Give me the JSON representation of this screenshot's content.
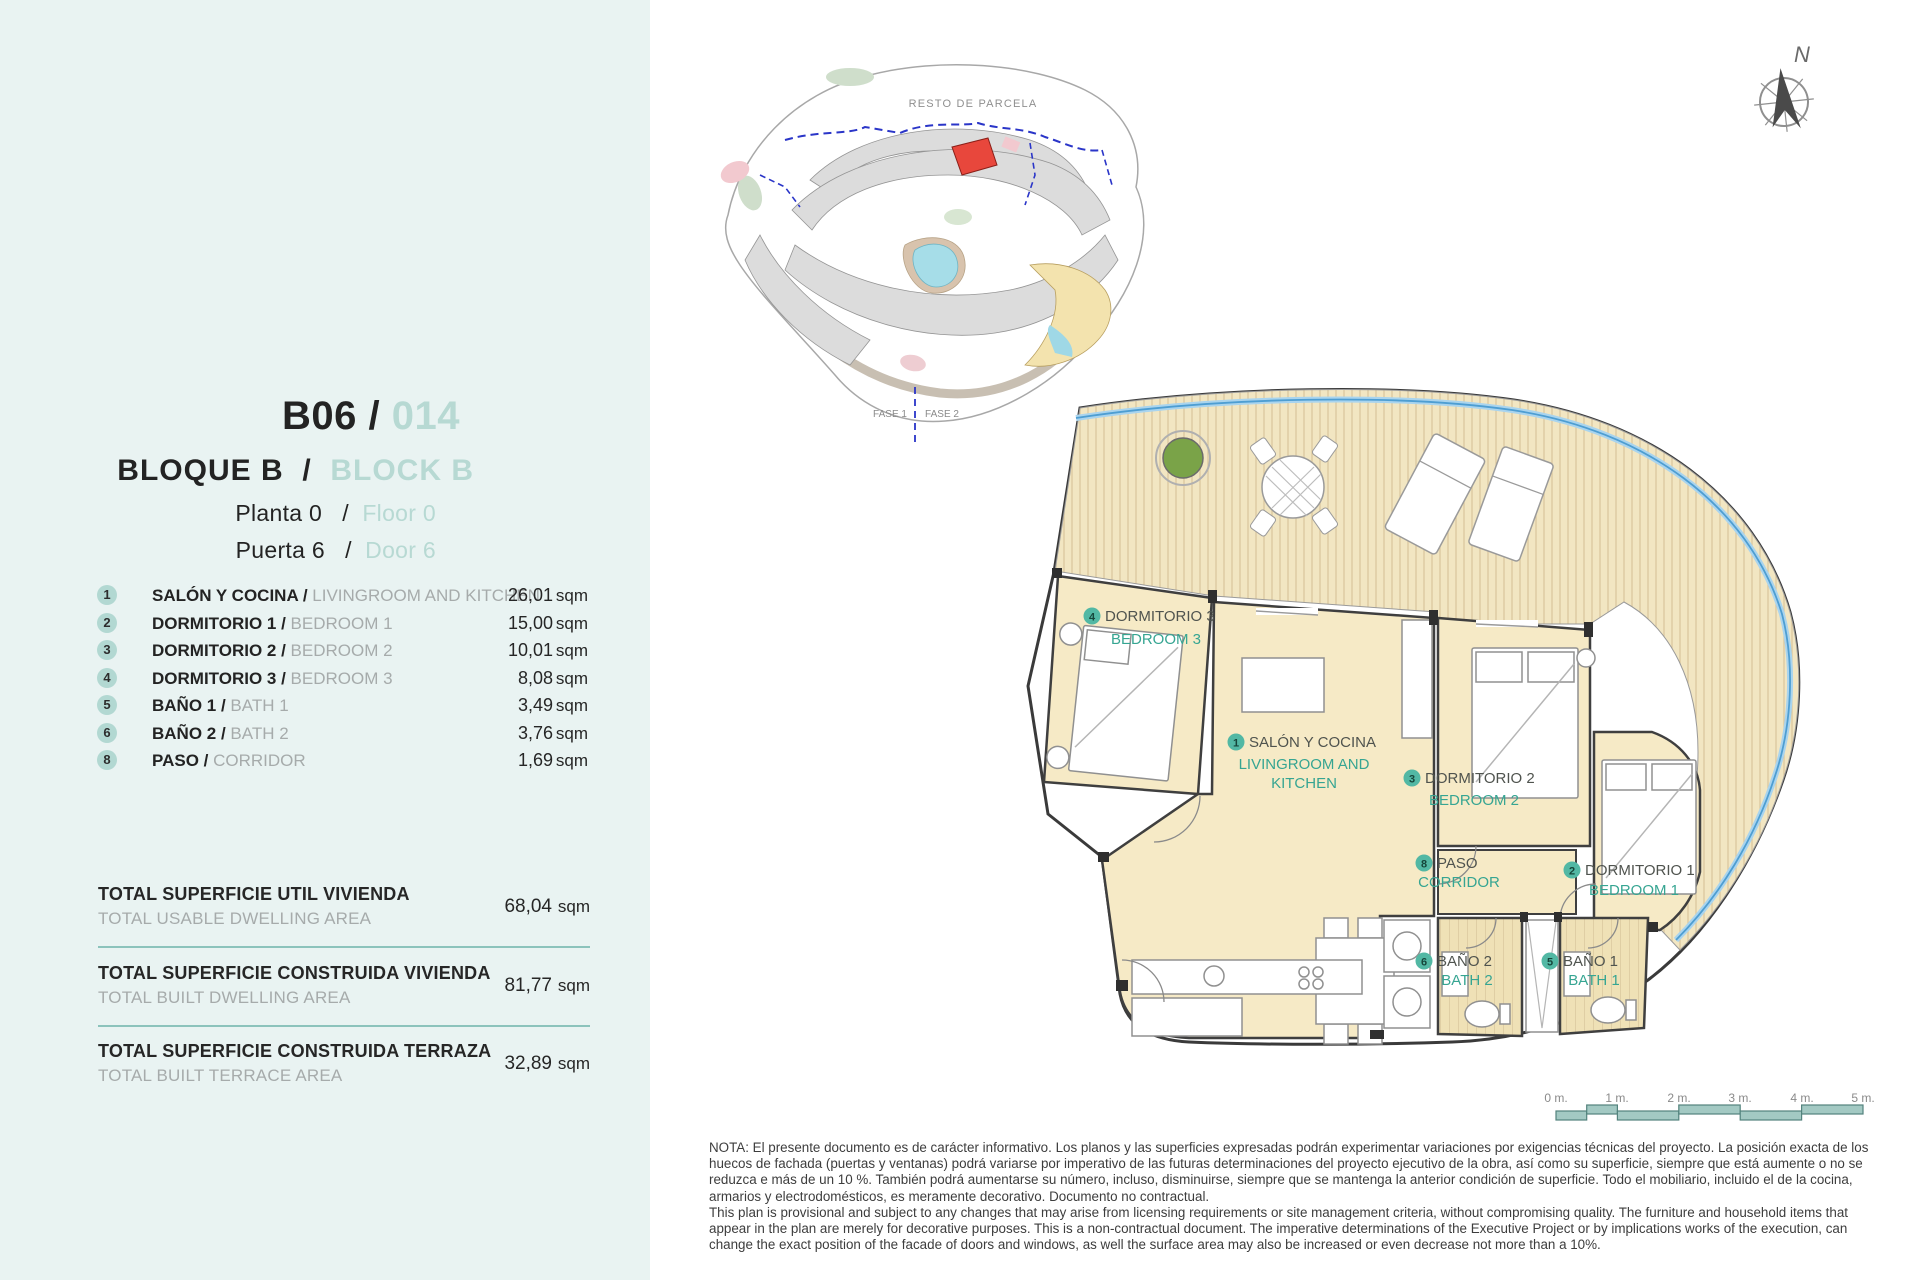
{
  "unit": {
    "code": "B06",
    "separator": "/",
    "number": "014",
    "block_es": "BLOQUE B",
    "block_en": "BLOCK B",
    "floor_es": "Planta 0",
    "floor_en": "Floor 0",
    "door_es": "Puerta 6",
    "door_en": "Door 6"
  },
  "rooms": [
    {
      "id": "1",
      "name_es": "SALÓN Y COCINA / ",
      "name_en": "LIVINGROOM AND KITCHEN",
      "area": "26,01",
      "unit": "sqm"
    },
    {
      "id": "2",
      "name_es": "DORMITORIO 1 / ",
      "name_en": "BEDROOM 1",
      "area": "15,00",
      "unit": "sqm"
    },
    {
      "id": "3",
      "name_es": "DORMITORIO 2 / ",
      "name_en": "BEDROOM 2",
      "area": "10,01",
      "unit": "sqm"
    },
    {
      "id": "4",
      "name_es": "DORMITORIO 3 / ",
      "name_en": "BEDROOM 3",
      "area": "8,08",
      "unit": "sqm"
    },
    {
      "id": "5",
      "name_es": "BAÑO 1 / ",
      "name_en": "BATH 1",
      "area": "3,49",
      "unit": "sqm"
    },
    {
      "id": "6",
      "name_es": "BAÑO 2 / ",
      "name_en": "BATH 2",
      "area": "3,76",
      "unit": "sqm"
    },
    {
      "id": "8",
      "name_es": "PASO / ",
      "name_en": "CORRIDOR",
      "area": "1,69",
      "unit": "sqm"
    }
  ],
  "totals": [
    {
      "label_es": "TOTAL SUPERFICIE UTIL VIVIENDA",
      "label_en": "TOTAL USABLE DWELLING AREA",
      "value": "68,04",
      "unit": "sqm"
    },
    {
      "label_es": "TOTAL SUPERFICIE CONSTRUIDA VIVIENDA",
      "label_en": "TOTAL BUILT DWELLING AREA",
      "value": "81,77",
      "unit": "sqm"
    },
    {
      "label_es": "TOTAL SUPERFICIE CONSTRUIDA TERRAZA",
      "label_en": "TOTAL BUILT TERRACE AREA",
      "value": "32,89",
      "unit": "sqm"
    }
  ],
  "site_plan": {
    "area_label": "RESTO DE PARCELA",
    "phase1": "FASE 1",
    "phase2": "FASE 2"
  },
  "compass": {
    "north": "N"
  },
  "floor_plan": {
    "salon": {
      "num": "1",
      "es": "SALÓN Y COCINA",
      "en1": "LIVINGROOM AND",
      "en2": "KITCHEN"
    },
    "dorm1": {
      "num": "2",
      "es": "DORMITORIO 1",
      "en": "BEDROOM 1"
    },
    "dorm2": {
      "num": "3",
      "es": "DORMITORIO 2",
      "en": "BEDROOM 2"
    },
    "dorm3": {
      "num": "4",
      "es": "DORMITORIO 3",
      "en": "BEDROOM 3"
    },
    "bath1": {
      "num": "5",
      "es": "BAÑO 1",
      "en": "BATH 1"
    },
    "bath2": {
      "num": "6",
      "es": "BAÑO 2",
      "en": "BATH 2"
    },
    "paso": {
      "num": "8",
      "es": "PASO",
      "en": "CORRIDOR"
    }
  },
  "scale_bar": {
    "labels": [
      "0 m.",
      "1 m.",
      "2 m.",
      "3 m.",
      "4 m.",
      "5 m."
    ]
  },
  "note": {
    "lines": [
      "NOTA: El presente documento es de carácter informativo. Los planos y las superficies expresadas podrán experimentar variaciones por exigencias técnicas del proyecto. La posición exacta de los",
      "huecos de fachada (puertas y ventanas) podrá variarse por imperativo de las futuras determinaciones del proyecto ejecutivo de la obra, así como su superficie, siempre que está aumente o no se",
      "reduzca e más de un 10 %. También podrá aumentarse su número, incluso, disminuirse, siempre que se mantenga la anterior condición de superficie. Todo el mobiliario, incluido el de la cocina,",
      "armarios y electrodomésticos, es meramente decorativo. Documento no contractual.",
      "This plan is provisional and subject to any changes that may arise from licensing requirements or site management criteria, without compromising quality. The furniture and household items that",
      "appear in the plan are merely for decorative purposes. This is a non-contractual document. The imperative determinations of the Executive Project or by implications works of the execution, can",
      "change the exact position of the facade of doors and windows, as well the surface area may also be increased or even decrease not more than a 10%."
    ]
  },
  "colors": {
    "sidebar_bg": "#e9f3f2",
    "accent_teal_light": "#b7d9d3",
    "accent_teal": "#36a592",
    "divider_teal": "#8cc3bc",
    "room_fill": "#f6eac6",
    "terrace_blue": "#5ea8d8",
    "highlight_red": "#e8473c",
    "scalebar_teal": "#a3c9c3"
  }
}
